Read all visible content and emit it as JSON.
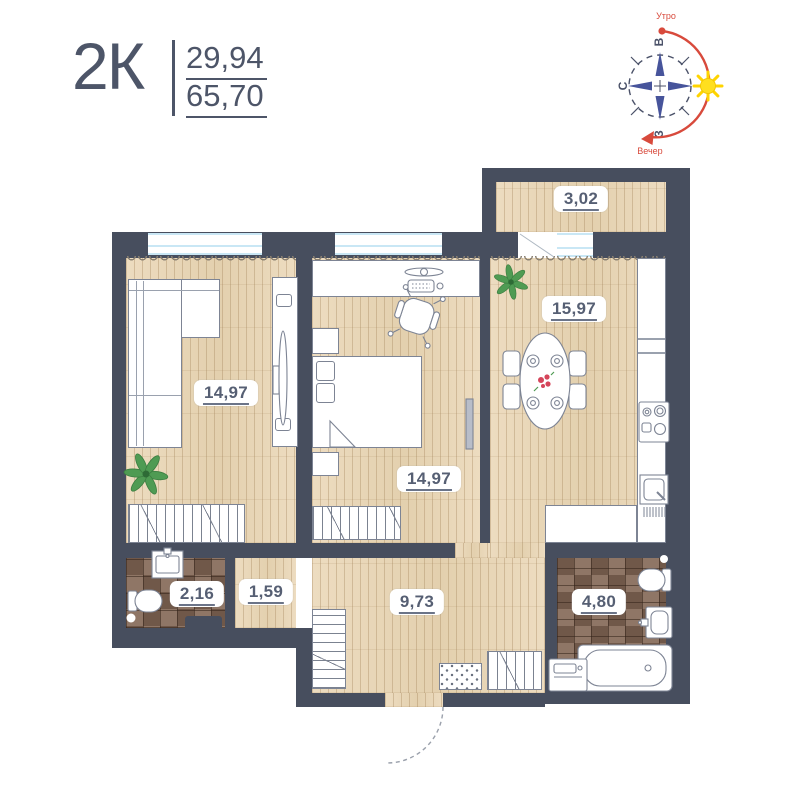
{
  "header": {
    "type_label": "2К",
    "living_area": "29,94",
    "total_area": "65,70"
  },
  "compass": {
    "morning_label": "Утро",
    "evening_label": "Вечер",
    "dir_top": "В",
    "dir_left": "С",
    "dir_bottom": "З"
  },
  "rooms": {
    "balcony": {
      "area": "3,02"
    },
    "kitchen": {
      "area": "15,97"
    },
    "living": {
      "area": "14,97"
    },
    "bedroom": {
      "area": "14,97"
    },
    "wc": {
      "area": "2,16"
    },
    "corridor": {
      "area": "1,59"
    },
    "hall": {
      "area": "9,73"
    },
    "bathroom": {
      "area": "4,80"
    }
  },
  "colors": {
    "wall": "#474e5e",
    "text": "#4d5568",
    "accent_red": "#d84a3c",
    "sun": "#ffdf1f",
    "winblue": "#c9e7f5",
    "wood_base": "#ecdcc0",
    "tile_base": "#826755"
  }
}
